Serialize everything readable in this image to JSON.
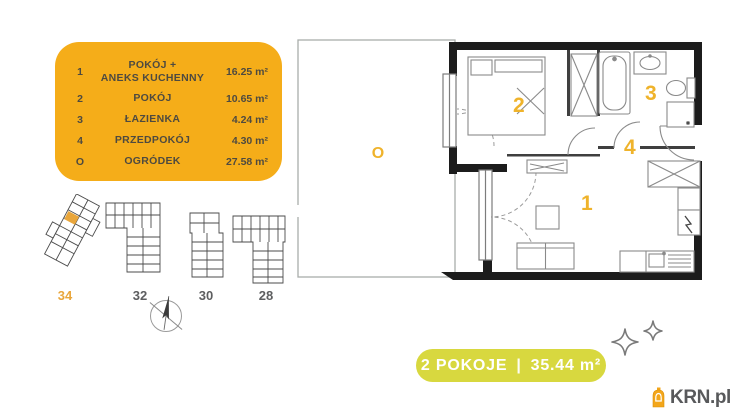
{
  "legend": {
    "bg_color": "#F5AD19",
    "rows": [
      {
        "num": "1",
        "name_line1": "POKÓJ +",
        "name_line2": "ANEKS KUCHENNY",
        "area": "16.25 m²"
      },
      {
        "num": "2",
        "name": "POKÓJ",
        "area": "10.65 m²"
      },
      {
        "num": "3",
        "name": "ŁAZIENKA",
        "area": "4.24 m²"
      },
      {
        "num": "4",
        "name": "PRZEDPOKÓJ",
        "area": "4.30 m²"
      },
      {
        "num": "O",
        "name": "OGRÓDEK",
        "area": "27.58 m²"
      }
    ]
  },
  "plan": {
    "accent_color": "#EFB32B",
    "labels": {
      "room1": "1",
      "room2": "2",
      "bathroom": "3",
      "hall": "4",
      "garden": "O"
    }
  },
  "site": {
    "buildings": [
      {
        "label": "34",
        "highlighted": true
      },
      {
        "label": "32",
        "highlighted": false
      },
      {
        "label": "30",
        "highlighted": false
      },
      {
        "label": "28",
        "highlighted": false
      }
    ]
  },
  "summary": {
    "rooms": "2 POKOJE",
    "separator": "|",
    "area": "35.44 m²",
    "bg_color": "#D8D83F"
  },
  "logo": {
    "text": "KRN.pl",
    "icon_color": "#F3A61A"
  }
}
